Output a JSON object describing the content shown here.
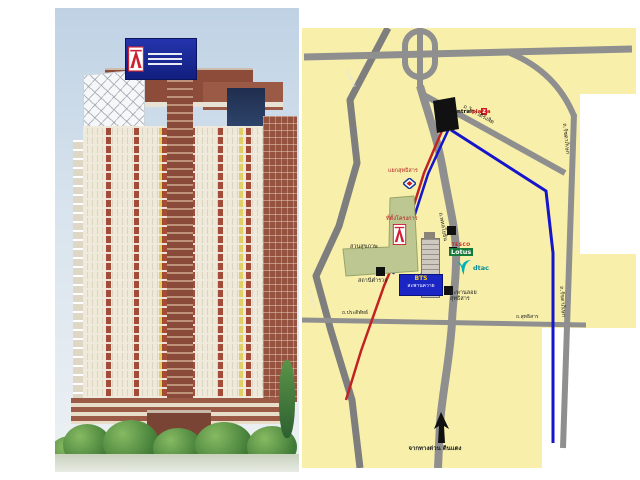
{
  "window": {
    "width": 640,
    "height": 480,
    "background": "#ffffff"
  },
  "left_panel": {
    "subject": "high-rise condominium tower rendering",
    "sky_color": "#c5d6e6",
    "facade_colors": {
      "cream": "#efe9da",
      "brick_red": "#8d4c39",
      "yellow_accent": "#e0cc5a",
      "glass_blue": "#22365a"
    },
    "rooftop_sign": {
      "background": "#1a27a0",
      "logo_colors": [
        "#ffffff",
        "#cc2233"
      ]
    }
  },
  "map": {
    "background": "#f8f0aa",
    "road_color": "#8f8f8f",
    "mrt_line_color": "#1515cc",
    "bts_line_color": "#c22222",
    "park_color": "#bdc792",
    "logos": {
      "centralplaza": {
        "p1": "central",
        "p2": "pla",
        "boxed": "z",
        "p3": "a"
      },
      "tesco": "TESCO",
      "lotus": "Lotus",
      "dtac": "dtac"
    },
    "labels": {
      "junction": "แยกสุทธิสาร",
      "park": "สวนสุขภาพ",
      "project_marker": "ที่ตั้งโครงการ",
      "police_station": "สถานีตำรวจ",
      "bts_station_line1": "BTS",
      "bts_station_line2": "สะพานควาย",
      "flyover_line1": "สะพานลอย",
      "flyover_line2": "สุทธิสาร",
      "from_expressway": "จากทางด่วน ดินแดง"
    },
    "roads": {
      "ratchadaphisek": "ถ.รัชดาภิเษก",
      "phahonyothin": "ถ.พหลโยธิน",
      "vibhavadi": "ถ.วิภาวดีรังสิต",
      "sutthisan": "ถ.สุทธิสาร",
      "pradipat": "ถ.ประดิพัทธ์",
      "expressway": "ทางด่วน"
    }
  }
}
